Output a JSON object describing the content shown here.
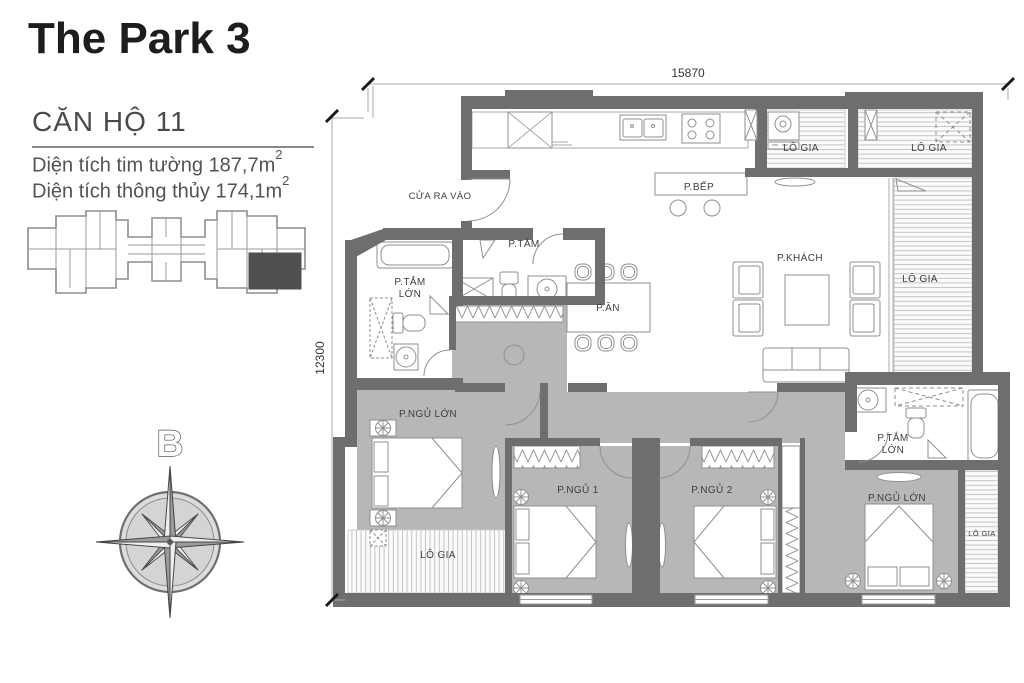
{
  "panel": {
    "title": "The Park 3",
    "unit_heading": "CĂN HỘ 11",
    "area_line1": {
      "text": "Diện tích tim tường 187,7m",
      "sup": "2"
    },
    "area_line2": {
      "text": "Diện tích thông thủy 174,1m",
      "sup": "2"
    }
  },
  "compass": {
    "north_label": "B"
  },
  "dimensions": {
    "width": "15870",
    "height": "12300"
  },
  "plan": {
    "labels": {
      "entrance": "CỬA RA VÀO",
      "kitchen": "P.BẾP",
      "balcony": "LÔ GIA",
      "bathroom": "P.TẮM",
      "bathroom_large_line1": "P.TẮM",
      "bathroom_large_line2": "LỚN",
      "dining": "P.ĂN",
      "living": "P.KHÁCH",
      "master_bedroom": "P.NGỦ LỚN",
      "bedroom1": "P.NGỦ 1",
      "bedroom2": "P.NGỦ 2"
    }
  },
  "colors": {
    "wall": "#6e6e6e",
    "floor_gray": "#b7b7b7",
    "highlight_unit": "#4f4f4f"
  }
}
